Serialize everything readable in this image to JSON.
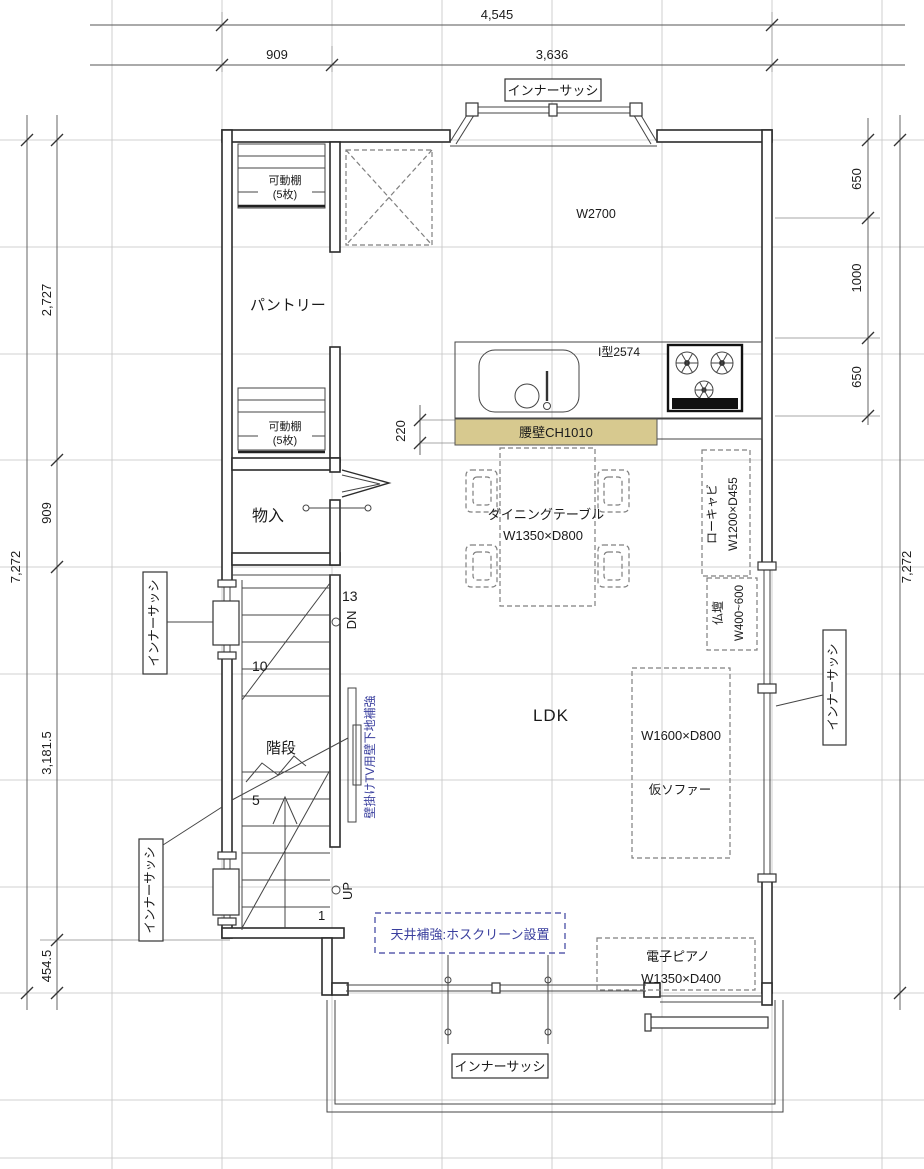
{
  "floor_plan": {
    "room_label": "LDK",
    "colors": {
      "counter_fill": "#d7c98f",
      "note_blue": "#3a3f9e"
    },
    "dims": {
      "top_total": "4,545",
      "top_seg1": "909",
      "top_seg2": "3,636",
      "left_total": "7,272",
      "left_seg1": "2,727",
      "left_seg2": "909",
      "left_seg3": "3,181.5",
      "left_seg4": "454.5",
      "right_total": "7,272",
      "right_seg1": "650",
      "right_seg2": "1000",
      "right_seg3": "650",
      "counter_depth": "220"
    },
    "labels": {
      "inner_sash": "インナーサッシ"
    },
    "kitchen": {
      "window_width": "W2700",
      "type": "I型2574",
      "waist_wall": "腰壁CH1010"
    },
    "pantry": {
      "label": "パントリー",
      "shelf": "可動棚",
      "shelf_qty": "(5枚)"
    },
    "storage": {
      "label": "物入"
    },
    "stairs": {
      "label": "階段",
      "n13": "13",
      "n10": "10",
      "n5": "5",
      "n1": "1",
      "dn": "DN",
      "up": "UP"
    },
    "furniture": {
      "dining_label": "ダイニングテーブル",
      "dining_size": "W1350×D800",
      "low_cab_label": "ローキャビ",
      "low_cab_size": "W1200×D455",
      "altar_label": "仏壇",
      "altar_size": "W400~600",
      "sofa_size": "W1600×D800",
      "sofa_label": "仮ソファー",
      "piano_label": "電子ピアノ",
      "piano_size": "W1350×D400"
    },
    "notes": {
      "tv": "壁掛けTV用壁下地補強",
      "ceiling": "天井補強:ホスクリーン設置"
    }
  }
}
